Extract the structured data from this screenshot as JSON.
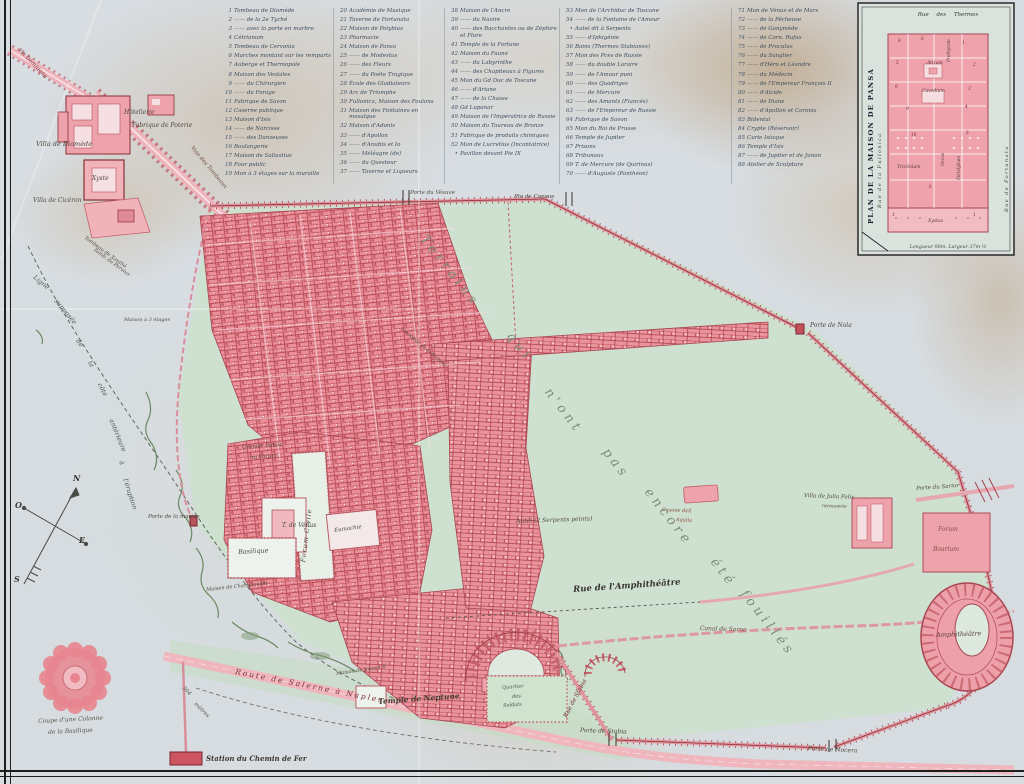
{
  "colors": {
    "paper": "#d8dde2",
    "excavation_pink": "#ea8e99",
    "unexcavated_green": "#cde0cd",
    "wall_red": "#a84550",
    "ink": "#4f4a3e",
    "legend_ink": "#3d4e5c"
  },
  "compass": {
    "n": "N",
    "o": "O",
    "e": "E",
    "s": "S"
  },
  "legend": {
    "columns": [
      {
        "x": 223,
        "w": 112,
        "entries": [
          {
            "n": "1",
            "label": "Tombeau de Diomède"
          },
          {
            "n": "2",
            "label": "—— de la 2e Tyché"
          },
          {
            "n": "3",
            "label": "—— avec la porte en marbre"
          },
          {
            "n": "4",
            "label": "Cétrianum"
          },
          {
            "n": "5",
            "label": "Tombeau de Cervonia"
          },
          {
            "n": "6",
            "label": "Marches montant sur les remparts"
          },
          {
            "n": "7",
            "label": "Auberge et Thermopole"
          },
          {
            "n": "8",
            "label": "Maison des Vestales"
          },
          {
            "n": "9",
            "label": "—— du Chirurgien"
          },
          {
            "n": "10",
            "label": "—— du Forage"
          },
          {
            "n": "11",
            "label": "Fabrique de Savon"
          },
          {
            "n": "12",
            "label": "Caserne publique"
          },
          {
            "n": "13",
            "label": "Maison d'Isis"
          },
          {
            "n": "14",
            "label": "—— de Narcisse"
          },
          {
            "n": "15",
            "label": "—— des Danseuses"
          },
          {
            "n": "16",
            "label": "Boulangerie"
          },
          {
            "n": "17",
            "label": "Maison de Sallustius"
          },
          {
            "n": "18",
            "label": "Four public"
          },
          {
            "n": "19",
            "label": "Mon à 3 étages sur la muraille"
          }
        ]
      },
      {
        "x": 338,
        "w": 108,
        "entries": [
          {
            "n": "20",
            "label": "Académie de Musique"
          },
          {
            "n": "21",
            "label": "Taverne de Fortunata"
          },
          {
            "n": "22",
            "label": "Maison de Polybius"
          },
          {
            "n": "23",
            "label": "Pharmacie"
          },
          {
            "n": "24",
            "label": "Maison de Pansa"
          },
          {
            "n": "25",
            "label": "—— de Modestus"
          },
          {
            "n": "26",
            "label": "—— des Fleurs"
          },
          {
            "n": "27",
            "label": "—— du Poète Tragique"
          },
          {
            "n": "28",
            "label": "École des Gladiateurs"
          },
          {
            "n": "29",
            "label": "Arc de Triomphe"
          },
          {
            "n": "30",
            "label": "Fullonica, Maison des Foulons"
          },
          {
            "n": "31",
            "label": "Maison des Fontaines en mosaïque"
          },
          {
            "n": "32",
            "label": "Maison d'Adonis"
          },
          {
            "n": "33",
            "label": "—— d'Apollon"
          },
          {
            "n": "34",
            "label": "—— d'Anubis et Io"
          },
          {
            "n": "35",
            "label": "—— Méléagre (de)"
          },
          {
            "n": "36",
            "label": "—— du Questeur"
          },
          {
            "n": "37",
            "label": "—— Taverne et Liqueurs"
          }
        ]
      },
      {
        "x": 449,
        "w": 112,
        "entries": [
          {
            "n": "38",
            "label": "Maison de l'Ancre"
          },
          {
            "n": "39",
            "label": "—— du Navire"
          },
          {
            "n": "40",
            "label": "—— des Bacchantes ou de Zéphire et Flore"
          },
          {
            "n": "41",
            "label": "Temple de la Fortune"
          },
          {
            "n": "42",
            "label": "Maison du Faune"
          },
          {
            "n": "43",
            "label": "—— du Labyrinthe"
          },
          {
            "n": "44",
            "label": "—— des Chapiteaux à Figures"
          },
          {
            "n": "45",
            "label": "Mon du Gd Duc de Toscane"
          },
          {
            "n": "46",
            "label": "—— d'Ariane"
          },
          {
            "n": "47",
            "label": "—— de la Chasse"
          },
          {
            "n": "48",
            "label": "Gd Lupanar"
          },
          {
            "n": "49",
            "label": "Maison de l'Impératrice de Russie"
          },
          {
            "n": "50",
            "label": "Maison du Taureau de Bronze"
          },
          {
            "n": "51",
            "label": "Fabrique de produits chimiques"
          },
          {
            "n": "52",
            "label": "Mon de Lucretius (Incantatrice)"
          },
          {
            "n": "•",
            "label": "Pavillon devant Pie IX"
          }
        ]
      },
      {
        "x": 564,
        "w": 166,
        "entries": [
          {
            "n": "53",
            "label": "Mon de l'Archiduc de Toscane"
          },
          {
            "n": "54",
            "label": "—— de la Fontaine de l'Amour"
          },
          {
            "n": "•",
            "label": "Autel dit à Serpents"
          },
          {
            "n": "55",
            "label": "—— d'Iphigénie"
          },
          {
            "n": "56",
            "label": "Bains (Thermes Stabianes)"
          },
          {
            "n": "57",
            "label": "Mon des Pces de Russie"
          },
          {
            "n": "58",
            "label": "—— du double Laraire"
          },
          {
            "n": "59",
            "label": "—— de l'Amour puni"
          },
          {
            "n": "60",
            "label": "—— des Quadriges"
          },
          {
            "n": "61",
            "label": "—— de Mercure"
          },
          {
            "n": "62",
            "label": "—— des Amants (Fiancés)"
          },
          {
            "n": "63",
            "label": "—— de l'Empereur de Russie"
          },
          {
            "n": "64",
            "label": "Fabrique de Savon"
          },
          {
            "n": "65",
            "label": "Mon du Roi de Prusse"
          },
          {
            "n": "66",
            "label": "Temple de Jupiter"
          },
          {
            "n": "67",
            "label": "Prisons"
          },
          {
            "n": "68",
            "label": "Tribunaux"
          },
          {
            "n": "69",
            "label": "T. de Mercure (de Quirinus)"
          },
          {
            "n": "70",
            "label": "—— d'Auguste (Panthéon)"
          }
        ]
      },
      {
        "x": 736,
        "w": 122,
        "entries": [
          {
            "n": "71",
            "label": "Mon de Vénus et de Mars"
          },
          {
            "n": "72",
            "label": "—— de la Pêcheuse"
          },
          {
            "n": "73",
            "label": "—— de Ganymède"
          },
          {
            "n": "74",
            "label": "—— de Corn. Rufus"
          },
          {
            "n": "75",
            "label": "—— de Proculus"
          },
          {
            "n": "76",
            "label": "—— du Sanglier"
          },
          {
            "n": "77",
            "label": "—— d'Héro et Léandre"
          },
          {
            "n": "78",
            "label": "—— du Médecin"
          },
          {
            "n": "79",
            "label": "—— de l'Empereur François II"
          },
          {
            "n": "80",
            "label": "—— d'Alcide"
          },
          {
            "n": "81",
            "label": "—— de Diane"
          },
          {
            "n": "82",
            "label": "—— d'Apollon et Coronis"
          },
          {
            "n": "83",
            "label": "Bidental"
          },
          {
            "n": "84",
            "label": "Crypte (Réservoir)"
          },
          {
            "n": "85",
            "label": "Curie Isiaque"
          },
          {
            "n": "86",
            "label": "Temple d'Isis"
          },
          {
            "n": "87",
            "label": "—— de Jupiter et de Junon"
          },
          {
            "n": "88",
            "label": "Atelier de Sculpture"
          }
        ]
      }
    ]
  },
  "inset": {
    "title": "PLAN DE LA MAISON DE PANSA",
    "street_top": "Rue des Thermes",
    "street_left": "Rue de la Fullonica",
    "street_right": "Rue de Fortunata",
    "caption": "Longueur 98m. Largeur 37m ½"
  },
  "map_labels": [
    {
      "t": "Via Domitiana",
      "x": 20,
      "y": 48,
      "r": 46,
      "s": 5.5,
      "c": "#7a2f35"
    },
    {
      "t": "Villa de Diomède",
      "x": 36,
      "y": 141,
      "s": 6.5
    },
    {
      "t": "Hôtellerie",
      "x": 124,
      "y": 110,
      "s": 6
    },
    {
      "t": "Fabrique de Poterie",
      "x": 132,
      "y": 123,
      "s": 6
    },
    {
      "t": "Voie des Tombeaux",
      "x": 193,
      "y": 146,
      "r": 50,
      "s": 5.5,
      "c": "#6b4a3a"
    },
    {
      "t": "Xyste",
      "x": 92,
      "y": 176,
      "s": 6
    },
    {
      "t": "Villa de Cicéron",
      "x": 33,
      "y": 198,
      "s": 6
    },
    {
      "t": "Tombeau de Xanthé",
      "x": 86,
      "y": 236,
      "r": 36,
      "s": 5
    },
    {
      "t": "Temb. de Pervius",
      "x": 95,
      "y": 248,
      "r": 36,
      "s": 5
    },
    {
      "t": "Maison à 3 étages",
      "x": 124,
      "y": 318,
      "s": 5
    },
    {
      "t": "Ligne",
      "x": 36,
      "y": 274,
      "r": 40,
      "s": 6.5,
      "c": "#4f5a52"
    },
    {
      "t": "supposée",
      "x": 58,
      "y": 298,
      "r": 50,
      "s": 6.5,
      "c": "#4f5a52"
    },
    {
      "t": "de",
      "x": 80,
      "y": 338,
      "r": 56,
      "s": 6.5,
      "c": "#4f5a52"
    },
    {
      "t": "la",
      "x": 92,
      "y": 360,
      "r": 58,
      "s": 6.5,
      "c": "#4f5a52"
    },
    {
      "t": "côte",
      "x": 102,
      "y": 382,
      "r": 62,
      "s": 6.5,
      "c": "#4f5a52"
    },
    {
      "t": "antérieure",
      "x": 114,
      "y": 418,
      "r": 68,
      "s": 6.5,
      "c": "#4f5a52"
    },
    {
      "t": "à",
      "x": 124,
      "y": 460,
      "r": 70,
      "s": 6.5,
      "c": "#4f5a52"
    },
    {
      "t": "l'éruption",
      "x": 128,
      "y": 478,
      "r": 72,
      "s": 6.5,
      "c": "#4f5a52"
    },
    {
      "t": "Porte de la marine",
      "x": 148,
      "y": 515,
      "s": 5.5
    },
    {
      "t": "Grenier Public",
      "x": 242,
      "y": 446,
      "r": -4,
      "s": 5.5
    },
    {
      "t": "ou Forum",
      "x": 250,
      "y": 456,
      "r": -4,
      "s": 5.5
    },
    {
      "t": "T. de Vénus",
      "x": 282,
      "y": 523,
      "s": 6
    },
    {
      "t": "Forum Civile",
      "x": 300,
      "y": 562,
      "r": -83,
      "s": 6.5,
      "ls": 1
    },
    {
      "t": "Eumachie",
      "x": 334,
      "y": 529,
      "r": -8,
      "s": 5.5
    },
    {
      "t": "Basilique",
      "x": 238,
      "y": 549,
      "r": -3,
      "s": 6.5
    },
    {
      "t": "Maison de Championnet",
      "x": 206,
      "y": 588,
      "r": -6,
      "s": 5
    },
    {
      "t": "Maison de Joseph II",
      "x": 336,
      "y": 672,
      "r": -8,
      "s": 5
    },
    {
      "t": "Temple de Neptune",
      "x": 378,
      "y": 698,
      "r": -4,
      "s": 7.5,
      "c": "#443e34",
      "fw": 600
    },
    {
      "t": "Quartier",
      "x": 502,
      "y": 686,
      "r": -4,
      "s": 5,
      "c": "#3f5a46"
    },
    {
      "t": "des",
      "x": 512,
      "y": 695,
      "r": -4,
      "s": 5,
      "c": "#3f5a46"
    },
    {
      "t": "Soldats",
      "x": 503,
      "y": 704,
      "r": -4,
      "s": 5,
      "c": "#3f5a46"
    },
    {
      "t": "Rue de Stabia",
      "x": 563,
      "y": 716,
      "r": -62,
      "s": 6,
      "c": "#6b2d33"
    },
    {
      "t": "Porte de Stabia",
      "x": 580,
      "y": 728,
      "r": 2,
      "s": 6
    },
    {
      "t": "Canal de Sarno",
      "x": 700,
      "y": 626,
      "r": 2,
      "s": 6,
      "c": "#6b4a38"
    },
    {
      "t": "Porte de Nocera",
      "x": 808,
      "y": 746,
      "r": 3,
      "s": 6
    },
    {
      "t": "Rue de l'Amphithéâtre",
      "x": 573,
      "y": 586,
      "r": -4,
      "s": 8.5,
      "c": "#38352e",
      "fw": 600
    },
    {
      "t": "Autel (2 Serpents peints)",
      "x": 516,
      "y": 519,
      "r": -2,
      "s": 6
    },
    {
      "t": "Casone dell",
      "x": 662,
      "y": 508,
      "r": 3,
      "s": 5,
      "c": "#8a4a42"
    },
    {
      "t": "Aquila",
      "x": 676,
      "y": 518,
      "r": 3,
      "s": 5,
      "c": "#8a4a42"
    },
    {
      "t": "Villa de Julia Felix",
      "x": 804,
      "y": 494,
      "r": 2,
      "s": 5.5
    },
    {
      "t": "recouverte",
      "x": 822,
      "y": 505,
      "r": 2,
      "s": 4.5
    },
    {
      "t": "Porte du Sarno",
      "x": 916,
      "y": 487,
      "r": -4,
      "s": 5.5
    },
    {
      "t": "Forum",
      "x": 938,
      "y": 527,
      "s": 6,
      "c": "#8a4a42"
    },
    {
      "t": "Boarium",
      "x": 933,
      "y": 547,
      "s": 6,
      "c": "#8a4a42"
    },
    {
      "t": "Amphithéâtre",
      "x": 936,
      "y": 632,
      "r": -2,
      "s": 6.5,
      "c": "#5a3a35"
    },
    {
      "t": "Porte de Nola",
      "x": 810,
      "y": 323,
      "s": 6
    },
    {
      "t": "Porte du Vésuve",
      "x": 410,
      "y": 191,
      "s": 5.5
    },
    {
      "t": "Pte de Capoue",
      "x": 514,
      "y": 195,
      "s": 5.5
    },
    {
      "t": "Terrains",
      "x": 428,
      "y": 233,
      "r": 52,
      "s": 13,
      "ls": 4,
      "c": "#7e8a7c"
    },
    {
      "t": "qui",
      "x": 514,
      "y": 330,
      "r": 52,
      "s": 13,
      "ls": 4,
      "c": "#7e8a7c"
    },
    {
      "t": "n'ont",
      "x": 552,
      "y": 386,
      "r": 52,
      "s": 13,
      "ls": 4,
      "c": "#7e8a7c"
    },
    {
      "t": "pas",
      "x": 610,
      "y": 446,
      "r": 52,
      "s": 13,
      "ls": 4,
      "c": "#7e8a7c"
    },
    {
      "t": "encore",
      "x": 652,
      "y": 486,
      "r": 52,
      "s": 13,
      "ls": 4,
      "c": "#7e8a7c"
    },
    {
      "t": "été",
      "x": 718,
      "y": 556,
      "r": 52,
      "s": 13,
      "ls": 4,
      "c": "#7e8a7c"
    },
    {
      "t": "fouillés",
      "x": 748,
      "y": 588,
      "r": 52,
      "s": 13,
      "ls": 4,
      "c": "#7e8a7c"
    },
    {
      "t": "Carrefour de la Fortune",
      "x": 402,
      "y": 328,
      "r": 40,
      "s": 4.8
    },
    {
      "t": "Route de Salerne à Naples",
      "x": 236,
      "y": 668,
      "r": 11,
      "s": 7.5,
      "ls": 2,
      "c": "#7a2f35"
    },
    {
      "t": "304",
      "x": 184,
      "y": 686,
      "r": 45,
      "s": 5.5,
      "c": "#55564a"
    },
    {
      "t": "mètres",
      "x": 196,
      "y": 702,
      "r": 45,
      "s": 5.5,
      "c": "#55564a"
    },
    {
      "t": "Station du Chemin de Fer",
      "x": 206,
      "y": 755,
      "s": 7,
      "c": "#3f3a32",
      "fw": 600
    },
    {
      "t": "Coupe d'une Colonne",
      "x": 38,
      "y": 719,
      "r": -3,
      "s": 6,
      "c": "#55564a"
    },
    {
      "t": "de la Basilique",
      "x": 48,
      "y": 730,
      "r": -3,
      "s": 6,
      "c": "#55564a"
    },
    {
      "t": "Prothyrum",
      "x": 947,
      "y": 62,
      "r": -90,
      "s": 4.2,
      "c": "#5a3a40"
    },
    {
      "t": "Atrium",
      "x": 927,
      "y": 62,
      "s": 4.5,
      "c": "#5a3a40"
    },
    {
      "t": "Cavedium",
      "x": 922,
      "y": 90,
      "s": 4.5,
      "c": "#5a3a40"
    },
    {
      "t": "Triclinium",
      "x": 897,
      "y": 166,
      "s": 4.5,
      "c": "#5a3a40"
    },
    {
      "t": "Peristylium",
      "x": 957,
      "y": 180,
      "r": -90,
      "s": 4.2,
      "c": "#5a3a40"
    },
    {
      "t": "Oecus",
      "x": 941,
      "y": 166,
      "r": -90,
      "s": 4.2,
      "c": "#5a3a40"
    },
    {
      "t": "Xystus",
      "x": 928,
      "y": 220,
      "s": 4.5,
      "c": "#5a3a40"
    },
    {
      "t": "8",
      "x": 898,
      "y": 40,
      "s": 4.3,
      "c": "#7a2730"
    },
    {
      "t": "6",
      "x": 921,
      "y": 38,
      "s": 4.3,
      "c": "#7a2730"
    },
    {
      "t": "1",
      "x": 962,
      "y": 42,
      "s": 4.3,
      "c": "#7a2730"
    },
    {
      "t": "5",
      "x": 896,
      "y": 62,
      "s": 4.3,
      "c": "#7a2730"
    },
    {
      "t": "2",
      "x": 973,
      "y": 64,
      "s": 4.3,
      "c": "#7a2730"
    },
    {
      "t": "9",
      "x": 895,
      "y": 86,
      "s": 4.3,
      "c": "#7a2730"
    },
    {
      "t": "3",
      "x": 968,
      "y": 88,
      "s": 4.3,
      "c": "#7a2730"
    },
    {
      "t": "9",
      "x": 906,
      "y": 108,
      "s": 4.3,
      "c": "#7a2730"
    },
    {
      "t": "4",
      "x": 965,
      "y": 106,
      "s": 4.3,
      "c": "#7a2730"
    },
    {
      "t": "10",
      "x": 911,
      "y": 134,
      "s": 4.3,
      "c": "#7a2730"
    },
    {
      "t": "5",
      "x": 966,
      "y": 132,
      "s": 4.3,
      "c": "#7a2730"
    },
    {
      "t": "h",
      "x": 929,
      "y": 186,
      "s": 4.3,
      "c": "#7a2730"
    },
    {
      "t": "1",
      "x": 892,
      "y": 214,
      "s": 4.3,
      "c": "#7a2730"
    },
    {
      "t": "1",
      "x": 973,
      "y": 214,
      "s": 4.3,
      "c": "#7a2730"
    }
  ]
}
